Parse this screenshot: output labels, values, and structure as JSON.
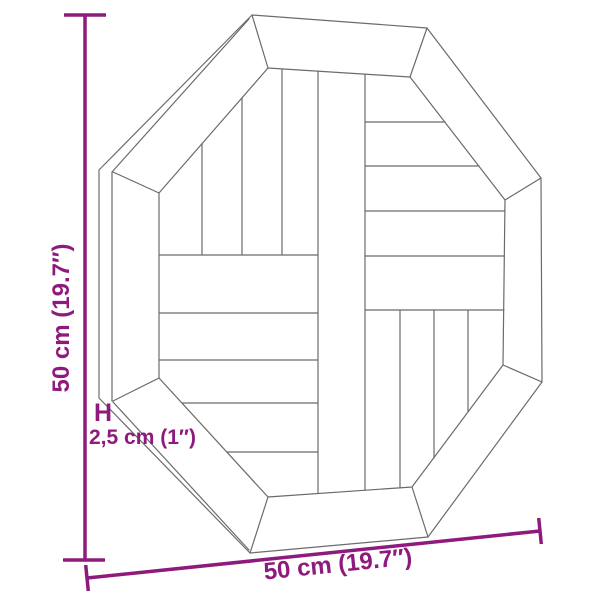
{
  "diagram": {
    "height_label": "50 cm (19.7″)",
    "width_label": "50 cm (19.7″)",
    "thickness_label": "2,5 cm (1″)",
    "thickness_marker": "H",
    "accent_color": "#8e1a7d",
    "line_color": "#6b6b6b",
    "background_color": "#ffffff"
  }
}
